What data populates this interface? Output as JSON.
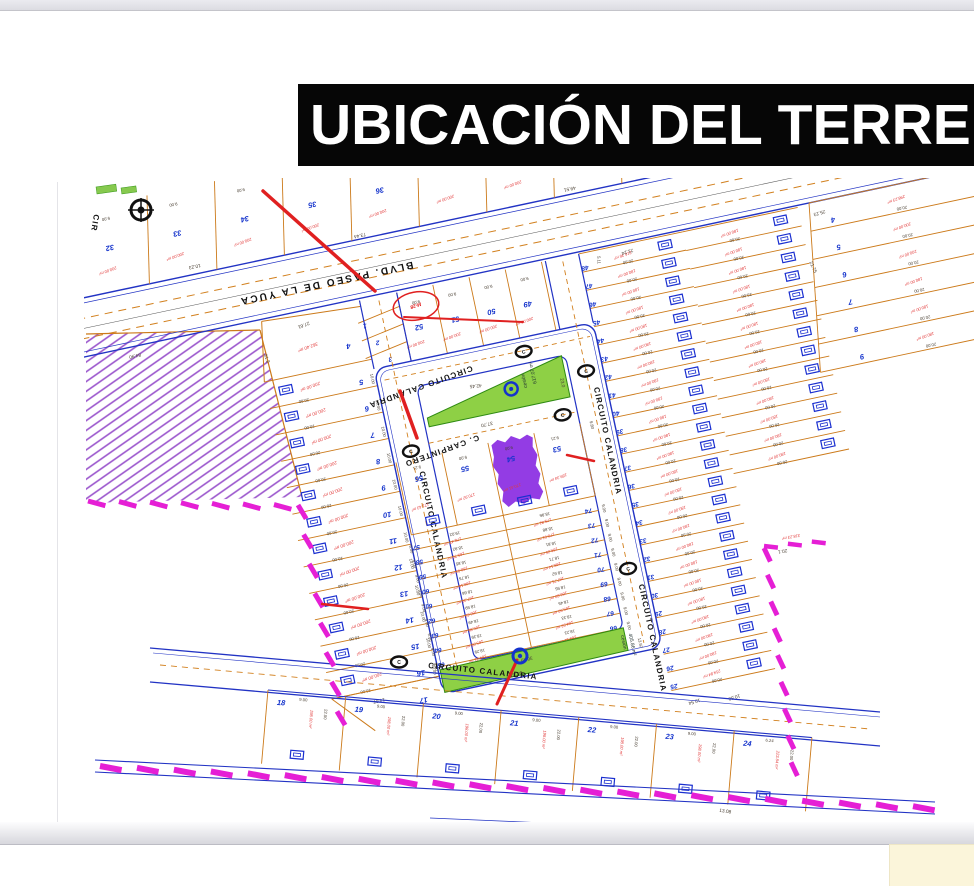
{
  "page": {
    "title": "UBICACIÓN DEL TERRENO"
  },
  "map": {
    "streets": {
      "blvd": "BLVD. PASEO DE LA YUCA",
      "circuito": "CIRCUITO CALANDRIA",
      "carpintero": "C. CARPINTERO",
      "cir": "CIR",
      "marker_letter": "C"
    },
    "markers": {
      "block_label": "M-28"
    },
    "green": {
      "triangle": {
        "label": "cesión",
        "area": "617.07 m²",
        "d1": "37.70",
        "d2": "42.45",
        "d3": "23.0"
      },
      "strip": {
        "label": "cesión",
        "area": "405.86 m²",
        "d1": "36.49",
        "d2": "34.32",
        "d3": "13.97"
      }
    },
    "blvd_dims": [
      "84.90",
      "73.44",
      "49.51",
      "15.51"
    ],
    "north": {
      "numbers": [
        "31",
        "32",
        "33",
        "34",
        "35",
        "36"
      ],
      "area": "200.00 m²",
      "top_dim": "9.00",
      "depths": [
        "10.19",
        "10.23"
      ]
    },
    "blockC": {
      "numbers": [
        "4",
        "5",
        "6",
        "7",
        "8",
        "9"
      ],
      "areas": [
        "298.23 m²",
        "200.00 m²",
        "200.00 m²",
        "180.00 m²",
        "180.00 m²",
        "180.00 m²"
      ],
      "dim": "20.00",
      "corner_dims": [
        "25.23",
        "21.75"
      ]
    },
    "south": {
      "numbers": [
        "52",
        "51",
        "50",
        "49"
      ],
      "trio": [
        "1",
        "2",
        "3"
      ],
      "area": "200.00 m²",
      "top_dim": "9.00"
    },
    "left": {
      "numbers": [
        "5",
        "6",
        "7",
        "8",
        "9",
        "10",
        "11",
        "12",
        "13",
        "14",
        "15",
        "16"
      ],
      "area": "200.00 m²",
      "d_long": "20.00",
      "d_short": "10.00",
      "lot4": {
        "no": "4",
        "area": "362.40 m²",
        "d1": "27.61",
        "d2": "31.2"
      },
      "lot17": {
        "no": "17",
        "d": "14.07"
      }
    },
    "right": {
      "colA": {
        "numbers": [
          "48",
          "47",
          "46",
          "45",
          "44",
          "43",
          "42",
          "41",
          "40",
          "39",
          "38",
          "37",
          "36",
          "35",
          "34",
          "33",
          "32",
          "31",
          "30",
          "29",
          "28",
          "27",
          "26",
          "25"
        ],
        "area": "180.00 m²",
        "dim": "20.00",
        "lot48": {
          "area": "216.36 m²",
          "d1": "21.24",
          "d2": "5.11"
        },
        "lot25": {
          "area": "254.84 m²",
          "d1": "10.54",
          "d2": "10.50"
        }
      },
      "colB": {
        "area": "180.00 m²",
        "dim": "20.00",
        "count": 13
      },
      "jog": {
        "d": "20.1",
        "area": "318.23 m²"
      }
    },
    "central": {
      "rowA": {
        "numbers": [
          "56",
          "55",
          "54",
          "53"
        ],
        "purple_no": "54",
        "top_dims": [
          "9.21",
          "9.00",
          "9.00",
          "9.21"
        ],
        "areas": [
          "171.43 m²",
          "170.92 m²",
          "170.41 m²",
          "189.34 m²"
        ],
        "side_dim": "9.80"
      },
      "row_side_dim": "9.00",
      "rows": [
        {
          "left_no": "57",
          "right_no": "74",
          "left_dim": "19.02",
          "right_dim": "18.96",
          "left_area": "170.47 m²",
          "right_area": "179.81 m²"
        },
        {
          "left_no": "58",
          "right_no": "73",
          "left_dim": "18.92",
          "right_dim": "18.88",
          "left_area": "169.70 m²",
          "right_area": "170.61 m²"
        },
        {
          "left_no": "59",
          "right_no": "72",
          "left_dim": "18.85",
          "right_dim": "18.81",
          "left_area": "168.93 m²",
          "right_area": "169.26 m²"
        },
        {
          "left_no": "60",
          "right_no": "71",
          "left_dim": "18.75",
          "right_dim": "18.71",
          "left_area": "168.16 m²",
          "right_area": "168.14 m²"
        },
        {
          "left_no": "61",
          "right_no": "70",
          "left_dim": "18.66",
          "right_dim": "18.62",
          "left_area": "167.39 m²",
          "right_area": "167.71 m²"
        },
        {
          "left_no": "62",
          "right_no": "69",
          "left_dim": "18.59",
          "right_dim": "18.55",
          "left_area": "166.62 m²",
          "right_area": "166.83 m²"
        },
        {
          "left_no": "63",
          "right_no": "68",
          "left_dim": "18.49",
          "right_dim": "18.45",
          "left_area": "165.85 m²",
          "right_area": "165.93 m²"
        },
        {
          "left_no": "64",
          "right_no": "67",
          "left_dim": "18.39",
          "right_dim": "18.33",
          "left_area": "165.08 m²",
          "right_area": "164.93 m²"
        },
        {
          "left_no": "65",
          "right_no": "66",
          "left_dim": "18.29",
          "right_dim": "18.23",
          "left_area": "164.31 m²",
          "right_area": "164.12 m²"
        }
      ]
    },
    "bottom": {
      "numbers": [
        "18",
        "19",
        "20",
        "21",
        "22",
        "23",
        "24"
      ],
      "area": "198.00 m²",
      "top_dim": "9.00",
      "side_dim": "22.00",
      "lot24": {
        "area": "223.84 m²",
        "d1": "6.24",
        "d2": "13.08"
      }
    },
    "colors": {
      "accent_blue": "#1433cc",
      "area_red": "#e23b3b",
      "lot_orange": "#cc7a1a",
      "green_fill": "#8ed045",
      "magenta": "#e51fd5",
      "purple": "#8a2be2",
      "street_blue": "#2233c4"
    }
  }
}
